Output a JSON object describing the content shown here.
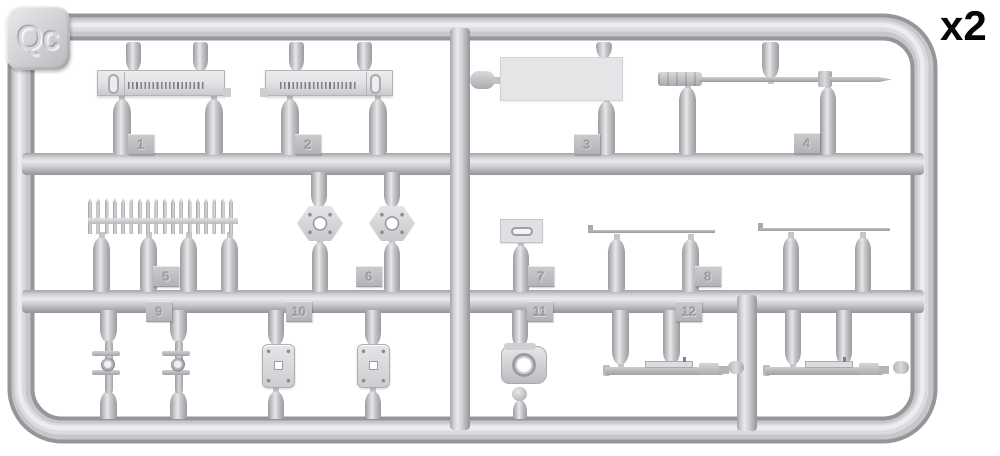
{
  "sprue": {
    "code": "Qc",
    "quantity": "x2",
    "part_numbers": [
      "1",
      "2",
      "3",
      "4",
      "5",
      "6",
      "7",
      "8",
      "9",
      "10",
      "11",
      "12"
    ]
  },
  "colors": {
    "background": "#ffffff",
    "plastic_mid": "#c6c7ca",
    "plastic_light": "#e9eaec",
    "plastic_dark": "#98999d",
    "quantity_text": "#050505"
  }
}
